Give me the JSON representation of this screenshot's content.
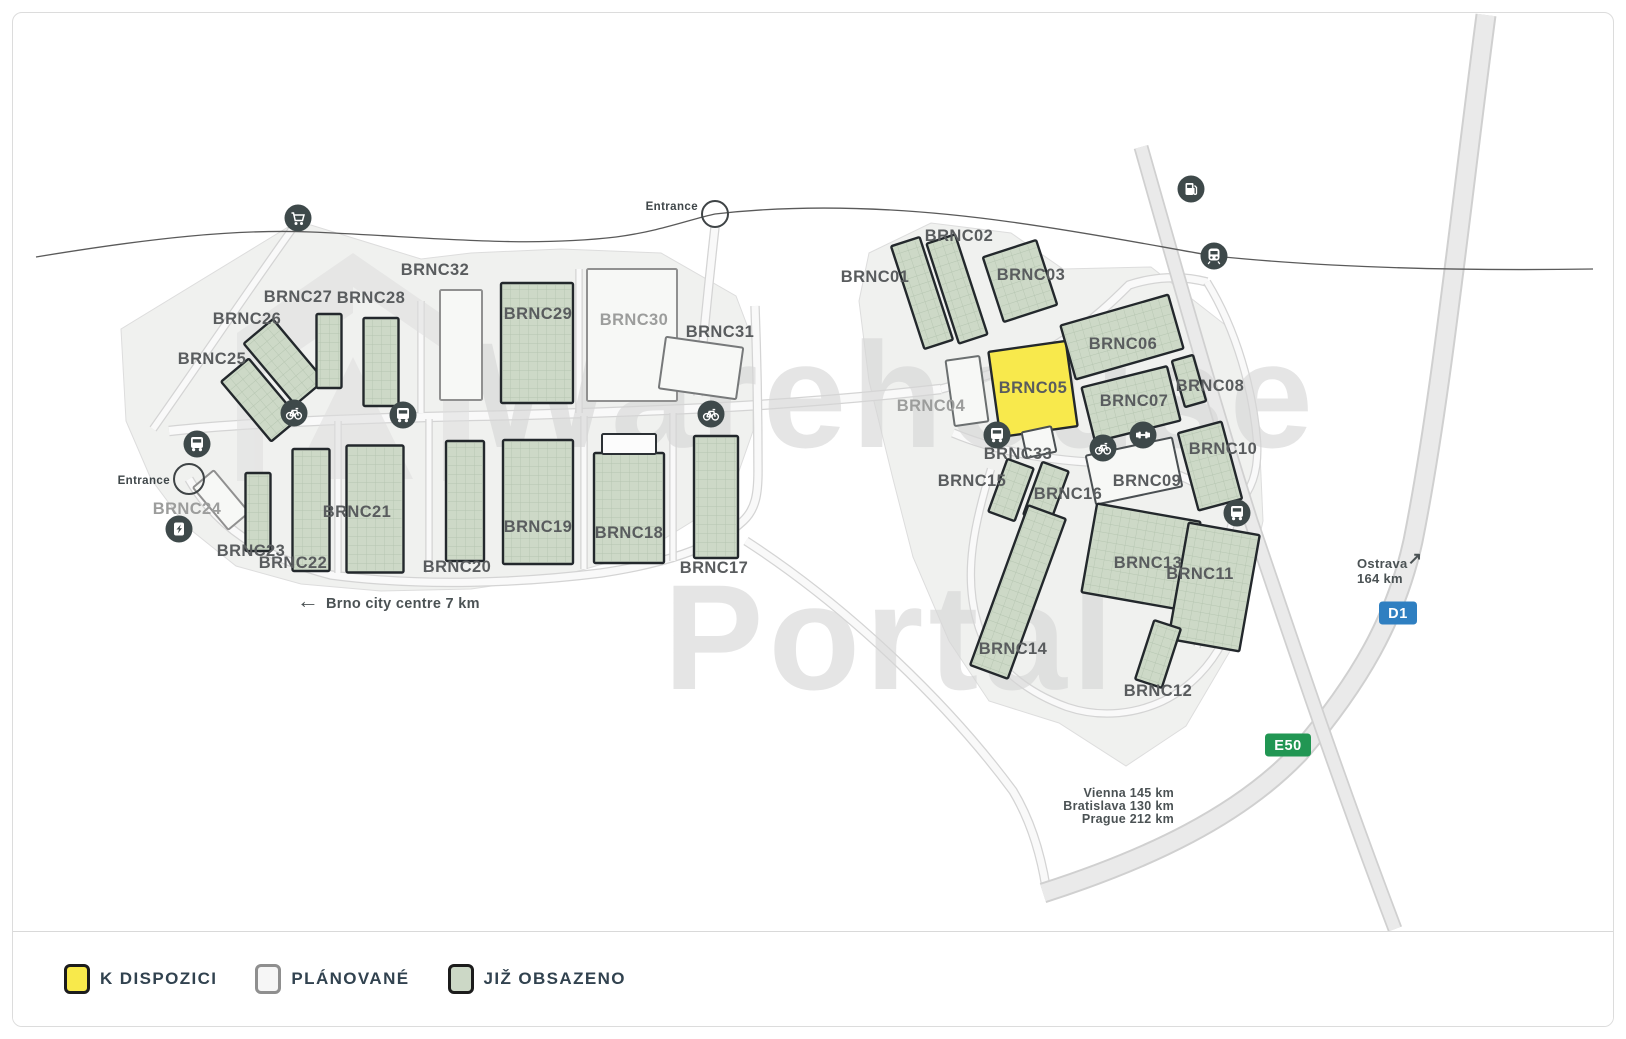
{
  "legend": {
    "items": [
      {
        "id": "available",
        "label": "K DISPOZICI",
        "swatch_fill": "#f8e94b",
        "swatch_border": "#1c1c1c"
      },
      {
        "id": "planned",
        "label": "PLÁNOVANÉ",
        "swatch_fill": "#f6f6f6",
        "swatch_border": "#8f8f8f"
      },
      {
        "id": "occupied",
        "label": "JIŽ OBSAZENO",
        "swatch_fill": "#ccd8c6",
        "swatch_border": "#1c1c1c"
      }
    ]
  },
  "map": {
    "watermark": {
      "line1": "Warehouse",
      "line2": "Portal"
    },
    "status_colors": {
      "available": "#f8e94c",
      "planned": "#f7f8f6",
      "occupied": "#cdd9c7",
      "outline": "#fcfcfc"
    },
    "entrances": [
      {
        "label": "Entrance",
        "cx": 714,
        "cy": 213,
        "r": 13,
        "label_x": 697,
        "label_y": 209
      },
      {
        "label": "Entrance",
        "cx": 188,
        "cy": 478,
        "r": 15,
        "label_x": 169,
        "label_y": 483
      }
    ],
    "badges": [
      {
        "label": "D1",
        "color": "#2f7fc1",
        "x": 1397,
        "y": 612,
        "w": 38
      },
      {
        "label": "E50",
        "color": "#219653",
        "x": 1287,
        "y": 744,
        "w": 46
      }
    ],
    "notes": [
      {
        "id": "brno-city-centre",
        "arrow": "←",
        "arrow_x": 307,
        "arrow_y": 607,
        "arrow_size": 22,
        "lines": [
          "Brno city centre 7 km"
        ],
        "x": 325,
        "y": 607,
        "anchor": "start",
        "size": 14.5,
        "line_h": 16
      },
      {
        "id": "ostrava",
        "arrow": "↗",
        "arrow_x": 1414,
        "arrow_y": 563,
        "arrow_size": 17,
        "lines": [
          "Ostrava",
          "164 km"
        ],
        "x": 1356,
        "y": 567,
        "anchor": "start",
        "size": 13,
        "line_h": 15
      },
      {
        "id": "southern-cities",
        "lines": [
          "Vienna 145 km",
          "Bratislava 130 km",
          "Prague 212 km"
        ],
        "x": 1173,
        "y": 796,
        "anchor": "end",
        "size": 12.5,
        "line_h": 13
      }
    ],
    "icons": [
      {
        "type": "shopping-cart",
        "x": 297,
        "y": 217
      },
      {
        "type": "bus-stop",
        "x": 196,
        "y": 443
      },
      {
        "type": "bike-path",
        "x": 293,
        "y": 412
      },
      {
        "type": "ev-charging",
        "x": 178,
        "y": 528
      },
      {
        "type": "bus-stop",
        "x": 402,
        "y": 414
      },
      {
        "type": "bike-path",
        "x": 710,
        "y": 413
      },
      {
        "type": "bus-stop",
        "x": 996,
        "y": 434
      },
      {
        "type": "bike-path",
        "x": 1102,
        "y": 447
      },
      {
        "type": "gym",
        "x": 1142,
        "y": 434
      },
      {
        "type": "bus-stop",
        "x": 1236,
        "y": 512
      },
      {
        "type": "fuel-station",
        "x": 1190,
        "y": 188
      },
      {
        "type": "train-station",
        "x": 1213,
        "y": 255
      }
    ],
    "buildings": [
      {
        "id": "BRNC01",
        "label": "BRNC01",
        "status": "occupied",
        "cx": 921,
        "cy": 292,
        "w": 30,
        "h": 108,
        "rot": -18,
        "lx": 874,
        "ly": 275
      },
      {
        "id": "BRNC02",
        "label": "BRNC02",
        "status": "occupied",
        "cx": 956,
        "cy": 288,
        "w": 30,
        "h": 105,
        "rot": -18,
        "lx": 958,
        "ly": 234
      },
      {
        "id": "BRNC03",
        "label": "BRNC03",
        "status": "occupied",
        "cx": 1019,
        "cy": 280,
        "w": 56,
        "h": 68,
        "rot": -18,
        "lx": 1030,
        "ly": 273
      },
      {
        "id": "BRNC04",
        "label": "BRNC04",
        "status": "planned",
        "stroke": "#6b6f70",
        "cx": 966,
        "cy": 390,
        "w": 34,
        "h": 66,
        "rot": -8,
        "lx": 930,
        "ly": 404,
        "muted": true
      },
      {
        "id": "BRNC05",
        "label": "BRNC05",
        "status": "available",
        "cx": 1032,
        "cy": 388,
        "w": 78,
        "h": 86,
        "rot": -8,
        "lx": 1032,
        "ly": 386
      },
      {
        "id": "BRNC06",
        "label": "BRNC06",
        "status": "occupied",
        "cx": 1121,
        "cy": 336,
        "w": 112,
        "h": 56,
        "rot": -16,
        "lx": 1122,
        "ly": 342
      },
      {
        "id": "BRNC07",
        "label": "BRNC07",
        "status": "occupied",
        "cx": 1130,
        "cy": 403,
        "w": 88,
        "h": 56,
        "rot": -14,
        "lx": 1133,
        "ly": 399
      },
      {
        "id": "BRNC08",
        "label": "BRNC08",
        "status": "occupied",
        "cx": 1188,
        "cy": 380,
        "w": 22,
        "h": 48,
        "rot": -16,
        "lx": 1209,
        "ly": 384
      },
      {
        "id": "BRNC09",
        "label": "BRNC09",
        "status": "planned",
        "stroke": "#4a4f52",
        "cx": 1133,
        "cy": 470,
        "w": 88,
        "h": 50,
        "rot": -12,
        "lx": 1146,
        "ly": 479
      },
      {
        "id": "BRNC10",
        "label": "BRNC10",
        "status": "occupied",
        "cx": 1209,
        "cy": 465,
        "w": 45,
        "h": 80,
        "rot": -15,
        "lx": 1222,
        "ly": 447
      },
      {
        "id": "BRNC33",
        "label": "BRNC33",
        "status": "planned",
        "stroke": "#4a4f52",
        "cx": 1038,
        "cy": 441,
        "w": 30,
        "h": 26,
        "rot": -12,
        "lx": 1017,
        "ly": 452
      },
      {
        "id": "BRNC15",
        "label": "BRNC15",
        "status": "occupied",
        "cx": 1010,
        "cy": 489,
        "w": 28,
        "h": 56,
        "rot": 20,
        "lx": 971,
        "ly": 479
      },
      {
        "id": "BRNC16",
        "label": "BRNC16",
        "status": "occupied",
        "cx": 1045,
        "cy": 492,
        "w": 28,
        "h": 56,
        "rot": 20,
        "lx": 1067,
        "ly": 492
      },
      {
        "id": "BRNC13",
        "label": "BRNC13",
        "status": "occupied",
        "cx": 1140,
        "cy": 556,
        "w": 105,
        "h": 90,
        "rot": 10,
        "lx": 1147,
        "ly": 561
      },
      {
        "id": "BRNC11",
        "label": "BRNC11",
        "status": "occupied",
        "cx": 1213,
        "cy": 586,
        "w": 72,
        "h": 118,
        "rot": 10,
        "lx": 1199,
        "ly": 572
      },
      {
        "id": "BRNC14",
        "label": "BRNC14",
        "status": "occupied",
        "cx": 1017,
        "cy": 591,
        "w": 40,
        "h": 170,
        "rot": 20,
        "lx": 1012,
        "ly": 647
      },
      {
        "id": "BRNC12",
        "label": "BRNC12",
        "status": "occupied",
        "cx": 1157,
        "cy": 653,
        "w": 28,
        "h": 62,
        "rot": 18,
        "lx": 1157,
        "ly": 689
      },
      {
        "id": "BRNC25",
        "label": "BRNC25",
        "status": "occupied",
        "cx": 259,
        "cy": 399,
        "w": 36,
        "h": 78,
        "rot": -40,
        "lx": 211,
        "ly": 357
      },
      {
        "id": "BRNC26",
        "label": "BRNC26",
        "status": "occupied",
        "cx": 283,
        "cy": 361,
        "w": 38,
        "h": 80,
        "rot": -40,
        "lx": 246,
        "ly": 317
      },
      {
        "id": "BRNC27",
        "label": "BRNC27",
        "status": "occupied",
        "cx": 328,
        "cy": 350,
        "w": 25,
        "h": 74,
        "rot": 0,
        "lx": 297,
        "ly": 295
      },
      {
        "id": "BRNC28",
        "label": "BRNC28",
        "status": "occupied",
        "cx": 380,
        "cy": 361,
        "w": 35,
        "h": 88,
        "rot": 0,
        "lx": 370,
        "ly": 296
      },
      {
        "id": "BRNC32",
        "label": "BRNC32",
        "status": "planned",
        "cx": 460,
        "cy": 344,
        "w": 42,
        "h": 110,
        "rot": 0,
        "lx": 434,
        "ly": 268
      },
      {
        "id": "BRNC29",
        "label": "BRNC29",
        "status": "occupied",
        "cx": 536,
        "cy": 342,
        "w": 72,
        "h": 120,
        "rot": 0,
        "lx": 537,
        "ly": 312
      },
      {
        "id": "BRNC30",
        "label": "BRNC30",
        "status": "planned",
        "cx": 631,
        "cy": 334,
        "w": 90,
        "h": 132,
        "rot": 0,
        "lx": 633,
        "ly": 318,
        "muted": true
      },
      {
        "id": "BRNC31",
        "label": "BRNC31",
        "status": "planned",
        "stroke": "#77797a",
        "cx": 700,
        "cy": 367,
        "w": 78,
        "h": 52,
        "rot": 8,
        "lx": 719,
        "ly": 330
      },
      {
        "id": "BRNC24",
        "label": "BRNC24",
        "status": "planned",
        "cx": 220,
        "cy": 499,
        "w": 27,
        "h": 55,
        "rot": -40,
        "lx": 186,
        "ly": 507,
        "muted": true
      },
      {
        "id": "BRNC23",
        "label": "BRNC23",
        "status": "occupied",
        "cx": 257,
        "cy": 511,
        "w": 25,
        "h": 78,
        "rot": 0,
        "lx": 250,
        "ly": 549
      },
      {
        "id": "BRNC22",
        "label": "BRNC22",
        "status": "occupied",
        "cx": 310,
        "cy": 509,
        "w": 37,
        "h": 122,
        "rot": 0,
        "lx": 292,
        "ly": 561
      },
      {
        "id": "BRNC21",
        "label": "BRNC21",
        "status": "occupied",
        "cx": 374,
        "cy": 508,
        "w": 57,
        "h": 127,
        "rot": 0,
        "lx": 356,
        "ly": 510
      },
      {
        "id": "BRNC20",
        "label": "BRNC20",
        "status": "occupied",
        "cx": 464,
        "cy": 500,
        "w": 38,
        "h": 120,
        "rot": 0,
        "lx": 456,
        "ly": 565
      },
      {
        "id": "BRNC19",
        "label": "BRNC19",
        "status": "occupied",
        "cx": 537,
        "cy": 501,
        "w": 70,
        "h": 124,
        "rot": 0,
        "lx": 537,
        "ly": 525
      },
      {
        "id": "BRNC18",
        "label": "BRNC18",
        "status": "occupied",
        "cx": 628,
        "cy": 507,
        "w": 70,
        "h": 110,
        "rot": 0,
        "lx": 628,
        "ly": 531
      },
      {
        "id": "BRNC17",
        "label": "BRNC17",
        "status": "occupied",
        "cx": 715,
        "cy": 496,
        "w": 44,
        "h": 122,
        "rot": 0,
        "lx": 713,
        "ly": 566
      },
      {
        "id": "",
        "label": "",
        "status": "outline",
        "cx": 628,
        "cy": 443,
        "w": 54,
        "h": 20,
        "rot": 0,
        "lx": 0,
        "ly": 0
      }
    ]
  }
}
